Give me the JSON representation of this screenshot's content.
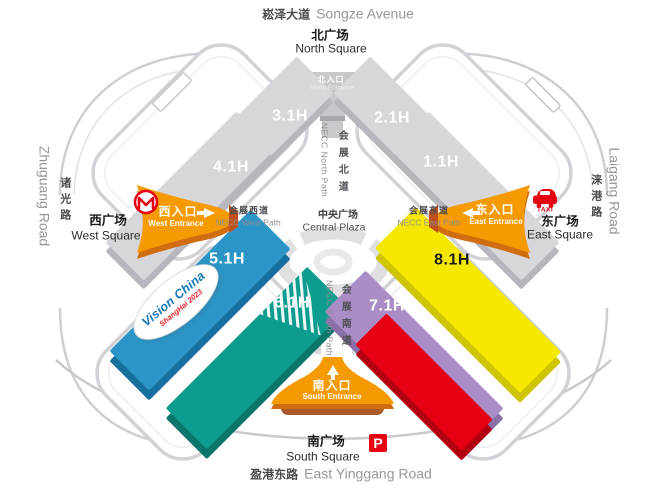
{
  "roads": {
    "songze": {
      "zh": "崧泽大道",
      "en": "Songze Avenue"
    },
    "yinggang": {
      "zh": "盈港东路",
      "en": "East Yinggang Road"
    },
    "zhuguang": {
      "zh": "诸光路",
      "en": "Zhuguang Road"
    },
    "laigang": {
      "zh": "涞港路",
      "en": "Laigang Road"
    }
  },
  "squares": {
    "north": {
      "zh": "北广场",
      "en": "North Square"
    },
    "south": {
      "zh": "南广场",
      "en": "South Square"
    },
    "west": {
      "zh": "西广场",
      "en": "West Square"
    },
    "east": {
      "zh": "东广场",
      "en": "East Square"
    }
  },
  "entrances": {
    "north": {
      "zh": "北入口",
      "en": "North Entrance"
    },
    "south": {
      "zh": "南入口",
      "en": "South Entrance"
    },
    "west": {
      "zh": "西入口",
      "en": "West Entrance"
    },
    "east": {
      "zh": "东入口",
      "en": "East Entrance"
    }
  },
  "paths": {
    "north": {
      "zh": "会展北道",
      "en": "NECC North Path"
    },
    "south": {
      "zh": "会展南道",
      "en": "NECC South Path"
    },
    "west": {
      "zh": "会展西道",
      "en": "NECC West Path"
    },
    "east": {
      "zh": "会展东道",
      "en": "NECC East Path"
    }
  },
  "plaza": {
    "zh": "中央广场",
    "en": "Central Plaza"
  },
  "halls": {
    "h11": "1.1H",
    "h21": "2.1H",
    "h31": "3.1H",
    "h41": "4.1H",
    "h51": "5.1H",
    "h61": "6.1H",
    "h71": "7.1H",
    "h81": "8.1H"
  },
  "event_badge": {
    "line1": "Vision China",
    "line2": "ShangHai 2023"
  },
  "icons": {
    "taxi_label": "TAXI",
    "parking_label": "P",
    "metro": "shanghai-metro-icon"
  },
  "colors": {
    "hall_gray": "#d7d7db",
    "hall_blue": "#2b95c7",
    "hall_teal": "#0d9c8e",
    "hall_purple": "#aa8dc7",
    "hall_yellow": "#f5e800",
    "hall_red": "#e60012",
    "entrance_orange": "#f59a00",
    "accent_red": "#e60012"
  }
}
